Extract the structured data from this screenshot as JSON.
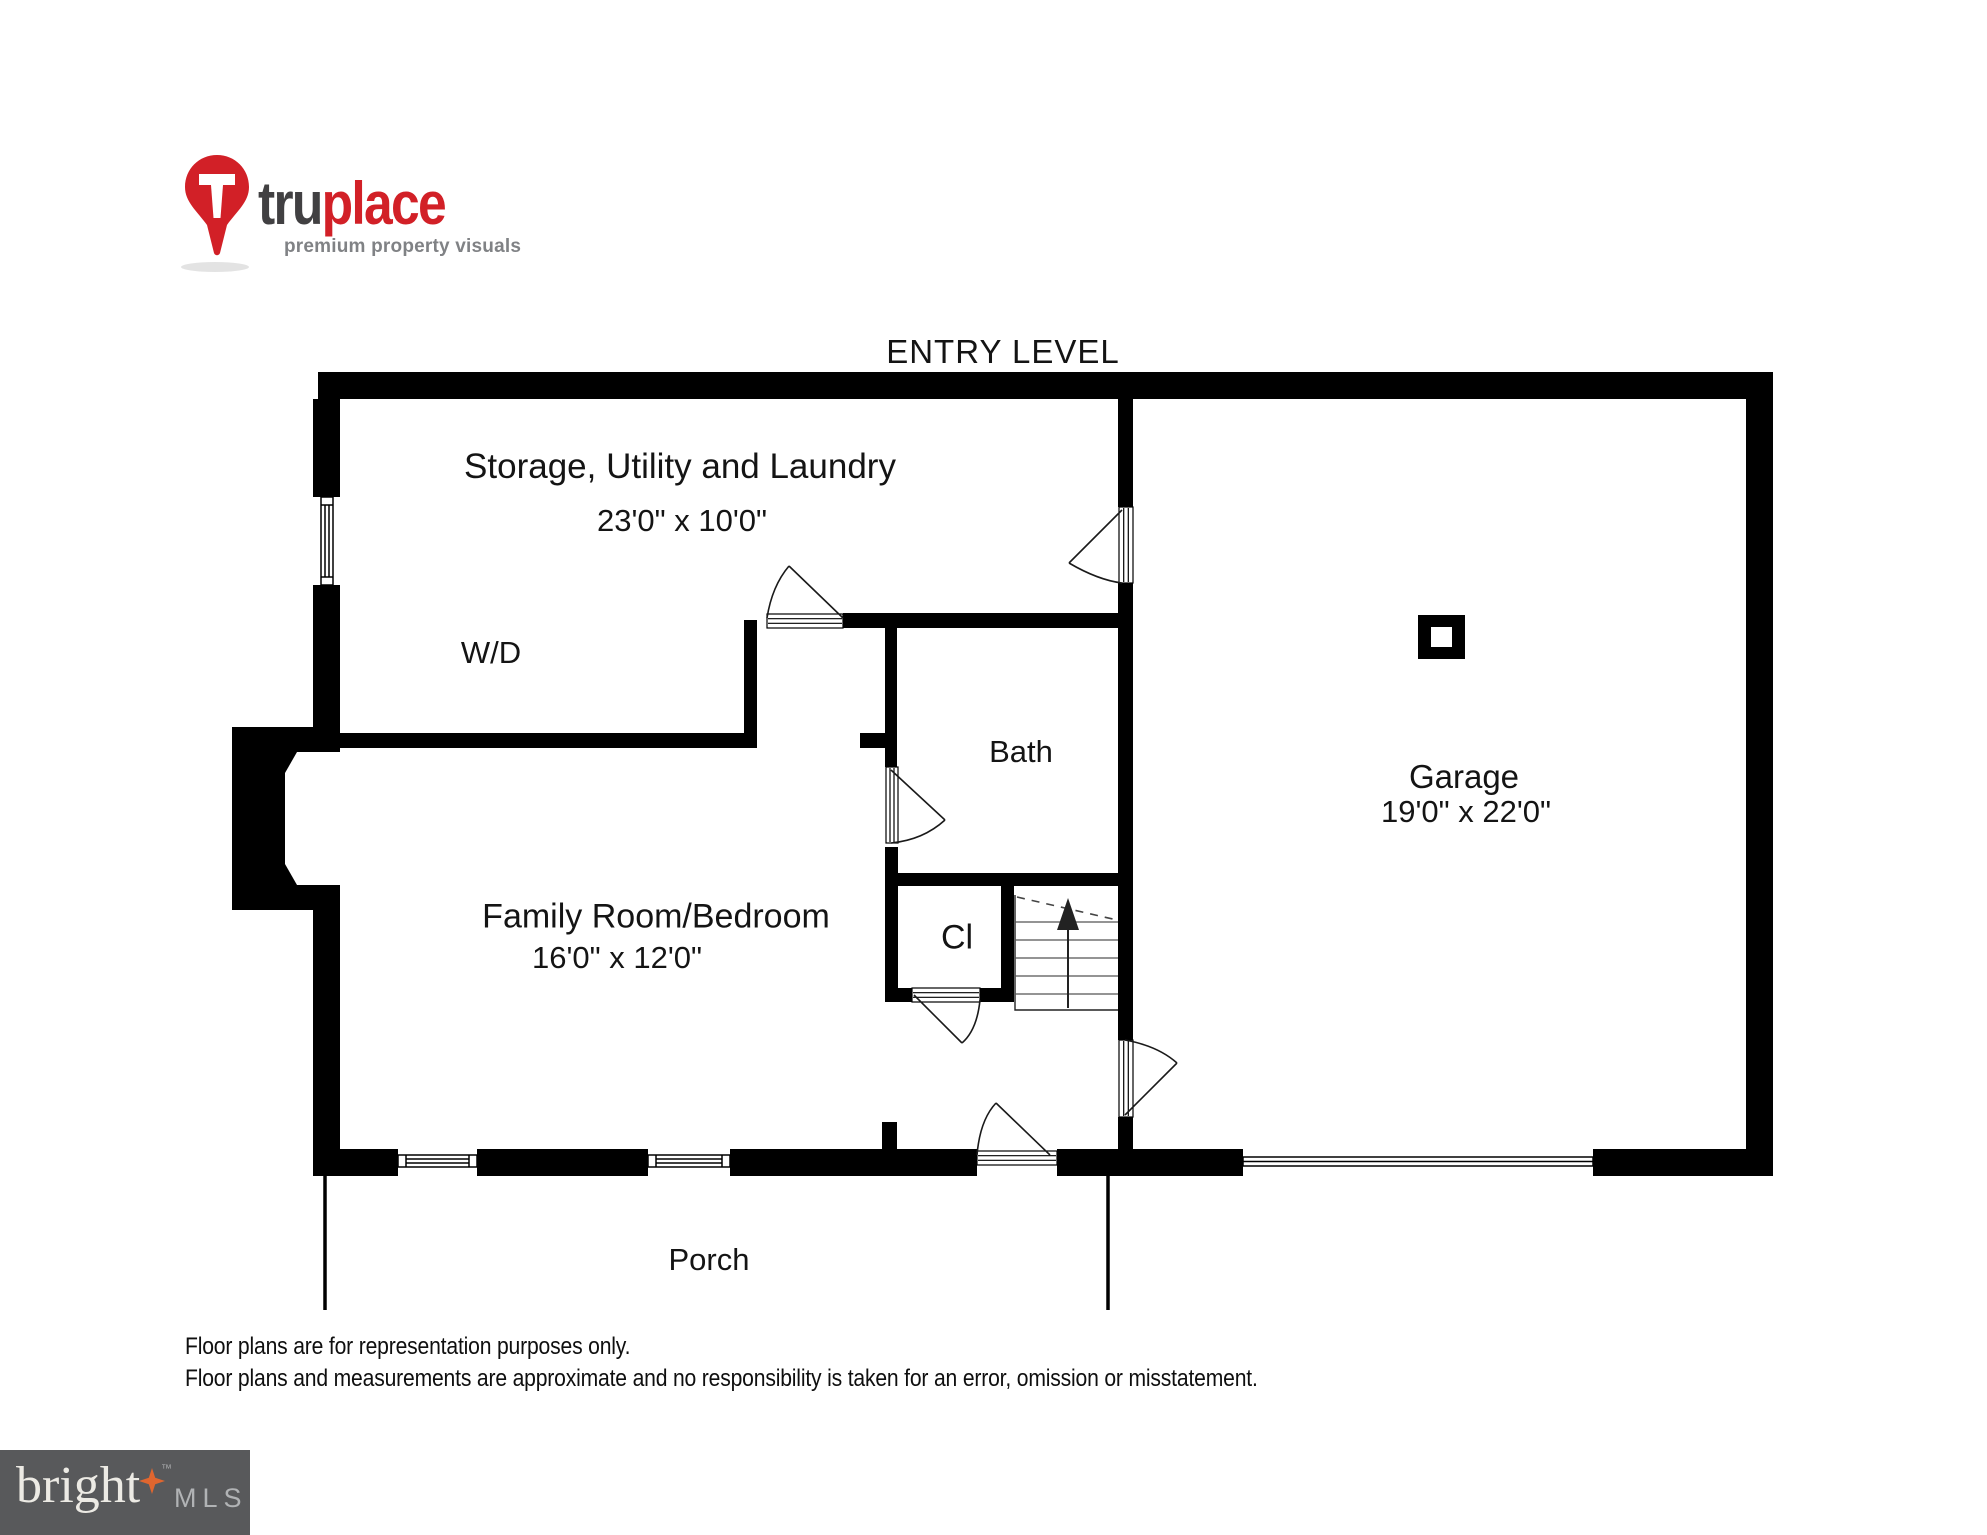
{
  "branding": {
    "truplace": {
      "name_prefix": "tru",
      "name_suffix": "place",
      "tagline": "premium property visuals",
      "pin_red": "#d22027",
      "prefix_gray": "#414042",
      "tagline_gray": "#808285"
    },
    "bright_mls": {
      "word": "bright",
      "tm": "™",
      "suffix": "MLS",
      "bg_color": "#58595b",
      "word_color": "#eceae4",
      "suffix_color": "#b1b3b5",
      "star_orange": "#e0662f"
    }
  },
  "title": "ENTRY LEVEL",
  "rooms": {
    "storage": {
      "name": "Storage, Utility and Laundry",
      "dims": "23'0\" x 10'0\""
    },
    "wd": {
      "label": "W/D"
    },
    "bath": {
      "name": "Bath"
    },
    "closet": {
      "name": "Cl"
    },
    "family": {
      "name": "Family Room/Bedroom",
      "dims": "16'0\" x 12'0\""
    },
    "garage": {
      "name": "Garage",
      "dims": "19'0\" x 22'0\""
    },
    "porch": {
      "name": "Porch"
    }
  },
  "disclaimer": {
    "line1": "Floor plans are for representation purposes only.",
    "line2": "Floor plans and measurements are approximate and no responsibility is taken for an error, omission or misstatement."
  },
  "colors": {
    "wall": "#000000",
    "label_text": "#141414",
    "background": "#ffffff"
  }
}
